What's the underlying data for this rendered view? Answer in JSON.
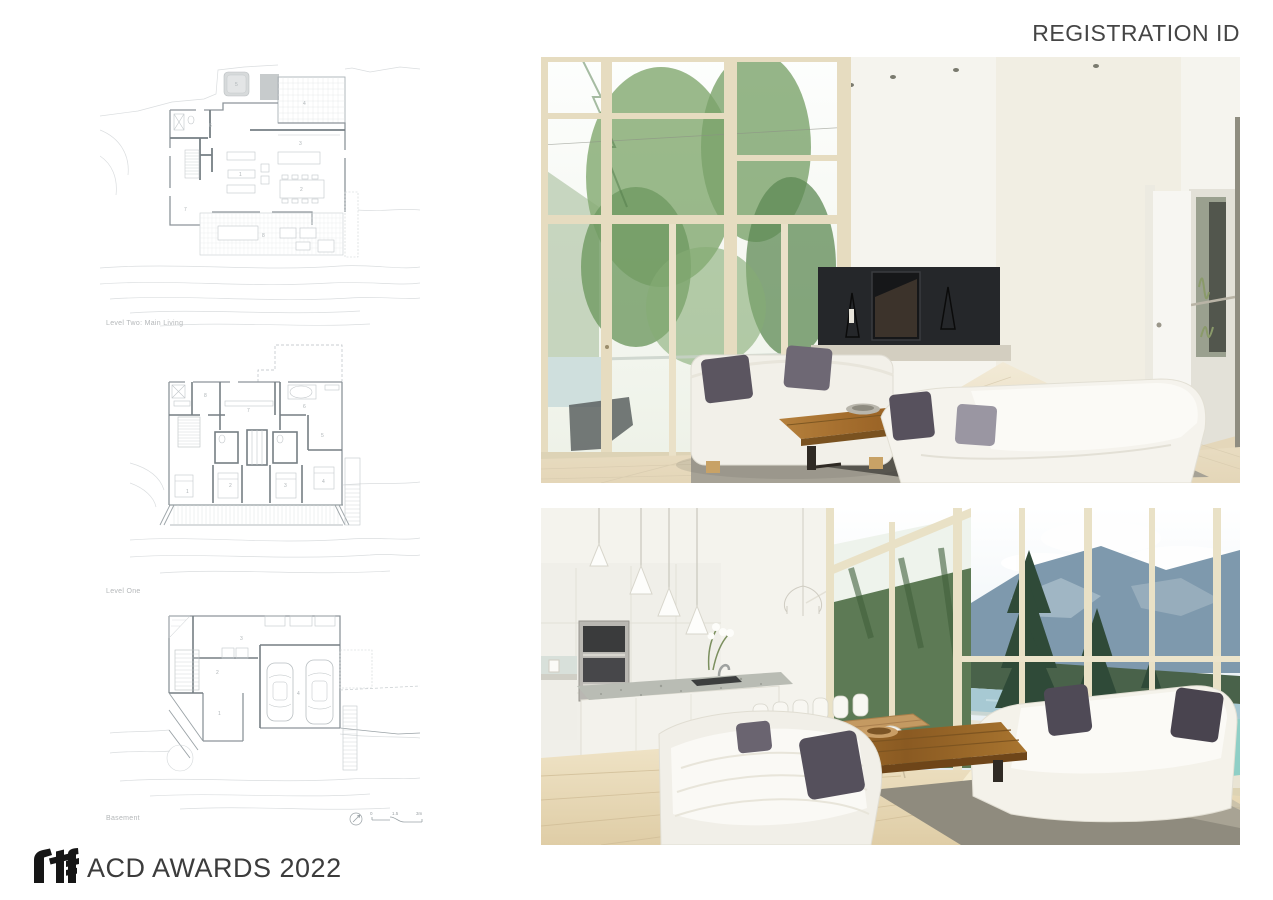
{
  "header": {
    "registration_label": "REGISTRATION ID"
  },
  "plans": {
    "level_two": {
      "label": "Level Two: Main Living",
      "rooms": [
        "1",
        "2",
        "3",
        "4",
        "5",
        "6",
        "7",
        "8"
      ]
    },
    "level_one": {
      "label": "Level One",
      "rooms": [
        "1",
        "2",
        "3",
        "4",
        "5",
        "6",
        "7",
        "8"
      ]
    },
    "basement": {
      "label": "Basement",
      "rooms": [
        "1",
        "2",
        "3",
        "4"
      ]
    },
    "scale": {
      "zero": "0",
      "mid": "1.5",
      "end": "3m"
    },
    "colors": {
      "wall": "#8d959a",
      "furniture": "#c2c7ca",
      "contour": "#dadddf",
      "label": "#b4b7b9"
    }
  },
  "photos": {
    "top": {
      "alt": "living room, floor-to-ceiling windows, black fireplace, two white sofas, wood coffee table"
    },
    "bottom": {
      "alt": "open-plan kitchen and dining with lake and mountain view"
    },
    "colors": {
      "fireplace": "#25272a",
      "floor": "#e9dec6",
      "pillow": "#55505c",
      "wood": "#a9752f",
      "mountain": "#7e99ad",
      "lake": "#a7c9d3",
      "deck_chair_teal": "#8fcfc6",
      "window_frame": "#e6dcc0"
    }
  },
  "footer": {
    "logo_mark": "rtf",
    "award_text": "ACD AWARDS 2022"
  }
}
